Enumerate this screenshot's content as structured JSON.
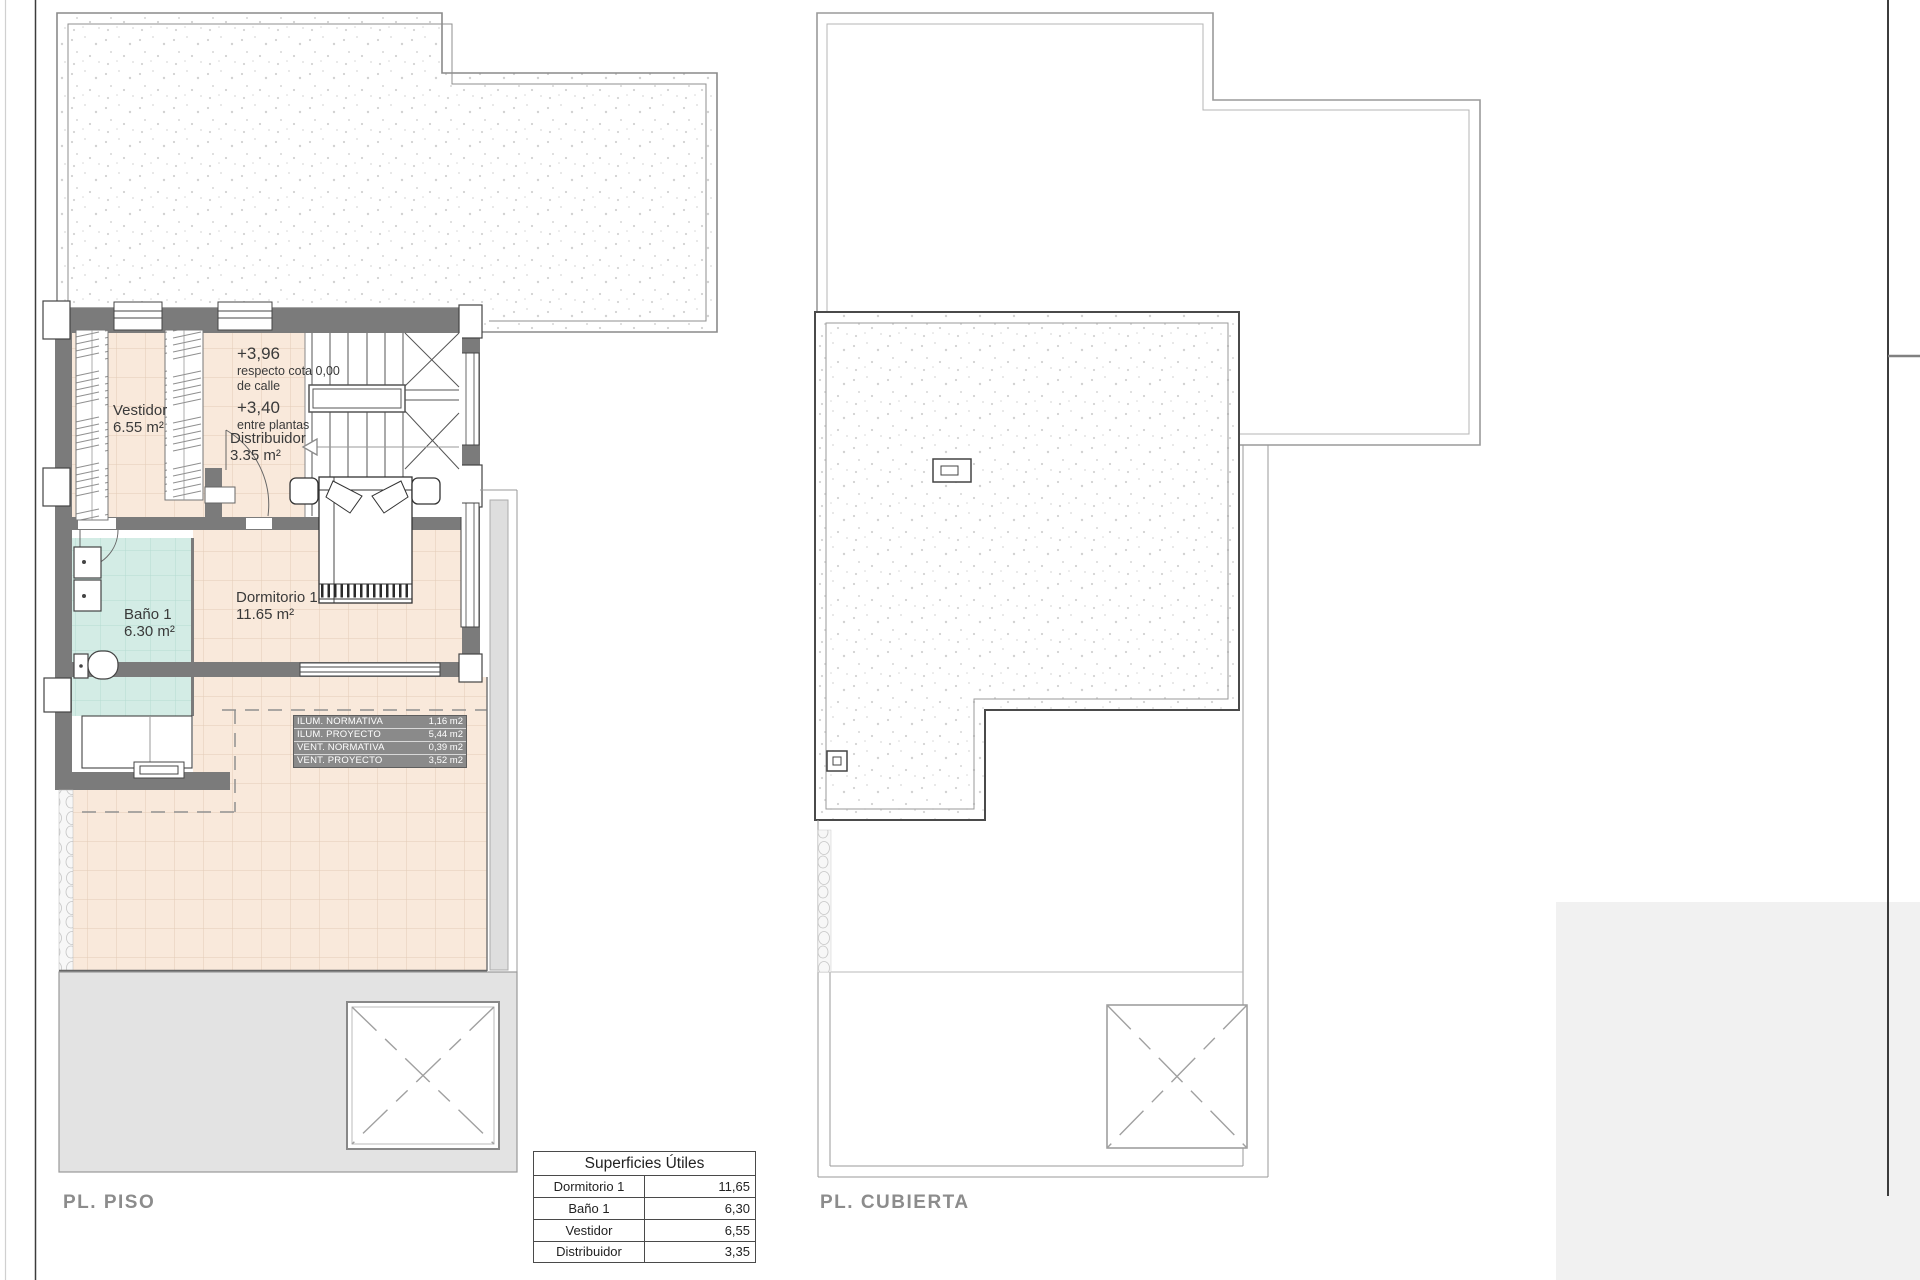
{
  "plans": {
    "piso": {
      "label": "PL. PISO",
      "rooms": {
        "vestidor": {
          "name": "Vestidor",
          "area": "6.55 m²"
        },
        "bano": {
          "name": "Baño 1",
          "area": "6.30 m²"
        },
        "dormitorio": {
          "name": "Dormitorio 1",
          "area": "11.65 m²"
        },
        "distribuidor": {
          "name": "Distribuidor",
          "area": "3.35 m²"
        }
      },
      "levels": {
        "upper": {
          "value": "+3,96",
          "line1": "respecto cota 0,00",
          "line2": "de calle"
        },
        "between": {
          "value": "+3,40",
          "line1": "entre plantas"
        }
      },
      "vent_table": {
        "rows": [
          {
            "label": "ILUM. NORMATIVA",
            "value": "1,16 m2"
          },
          {
            "label": "ILUM. PROYECTO",
            "value": "5,44 m2"
          },
          {
            "label": "VENT. NORMATIVA",
            "value": "0,39 m2"
          },
          {
            "label": "VENT. PROYECTO",
            "value": "3,52 m2"
          }
        ]
      }
    },
    "cubierta": {
      "label": "PL. CUBIERTA"
    }
  },
  "superficies": {
    "title": "Superficies Útiles",
    "rows": [
      {
        "room": "Dormitorio 1",
        "value": "11,65"
      },
      {
        "room": "Baño 1",
        "value": "6,30"
      },
      {
        "room": "Vestidor",
        "value": "6,55"
      },
      {
        "room": "Distribuidor",
        "value": "3,35"
      }
    ]
  },
  "colors": {
    "wall": "#7b7b7b",
    "floor_tile": "#f9e9db",
    "bath_tile": "#d3ece5",
    "terrace_gray": "#e3e3e3",
    "label_gray": "#8c8c8c",
    "vent_table_bg": "#8a8a8a"
  }
}
